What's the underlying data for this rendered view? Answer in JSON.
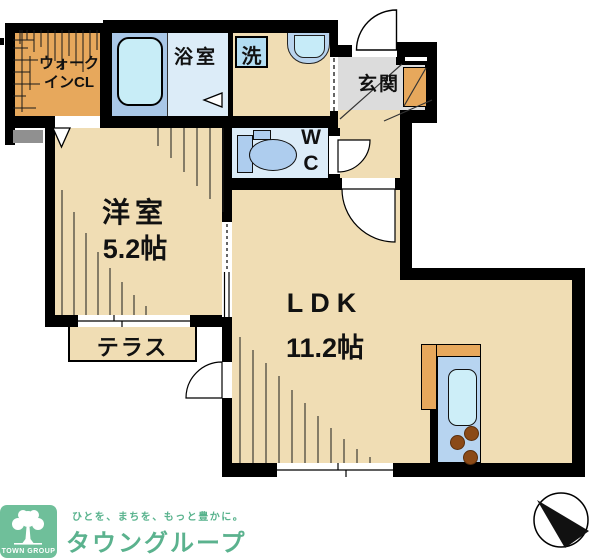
{
  "plan": {
    "rooms": {
      "walk_in_closet": {
        "label_line1": "ウォーク",
        "label_line2": "インCL"
      },
      "bathroom": {
        "label": "浴室"
      },
      "laundry": {
        "label": "洗"
      },
      "entrance": {
        "label": "玄関"
      },
      "toilet": {
        "label_line1": "W",
        "label_line2": "C"
      },
      "western_room": {
        "label": "洋室",
        "size": "5.2帖"
      },
      "ldk": {
        "label": "LDK",
        "size": "11.2帖"
      },
      "terrace": {
        "label": "テラス"
      }
    }
  },
  "branding": {
    "badge_label": "TOWN GROUP",
    "tagline": "ひとを、まちを、もっと豊かに。",
    "company_name": "タウングループ"
  },
  "colors": {
    "wall_black": "#000000",
    "floor_tan": "#f0ddb4",
    "closet_orange": "#e7a85c",
    "water_blue_light": "#dcecf8",
    "tub_fill_blue": "#c8edf7",
    "bath_surround_blue": "#a9c7e7",
    "fixture_blue": "#b3ddf2",
    "entrance_gray": "#dcdcdc",
    "step_gray": "#909090",
    "burner_brown": "#8b4a17",
    "brand_green": "#6fbf9a"
  }
}
